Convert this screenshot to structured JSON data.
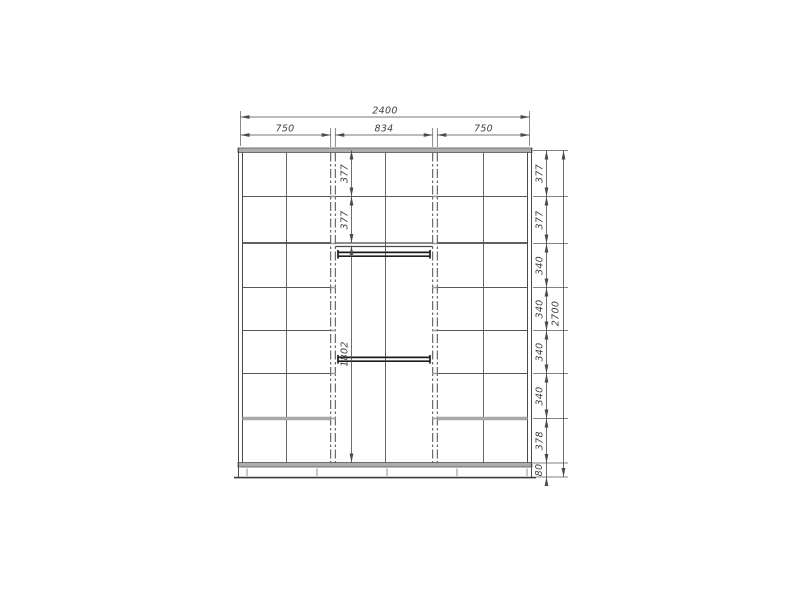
{
  "drawing": {
    "type": "wardrobe-front-elevation",
    "colors": {
      "background": "#ffffff",
      "line": "#4a4a4a",
      "panel_gray": "#adadad",
      "thick_shelf_gray": "#a8a8a8",
      "rod_black": "#1d1d1d",
      "dim_text": "#3f3f3f"
    },
    "dimensions": {
      "overall_width": "2400",
      "section_widths": [
        "750",
        "834",
        "750"
      ],
      "overall_height": "2700",
      "right_heights": [
        "377",
        "377",
        "340",
        "340",
        "340",
        "340",
        "378",
        "80"
      ],
      "middle_heights": [
        "377",
        "377",
        "1802"
      ]
    },
    "structure": {
      "left_section": {
        "columns": 2,
        "rows": 7
      },
      "middle_section": {
        "top_shelf_rows": 2,
        "hanging_rods": 2
      },
      "right_section": {
        "columns": 2,
        "rows": 7
      }
    }
  }
}
